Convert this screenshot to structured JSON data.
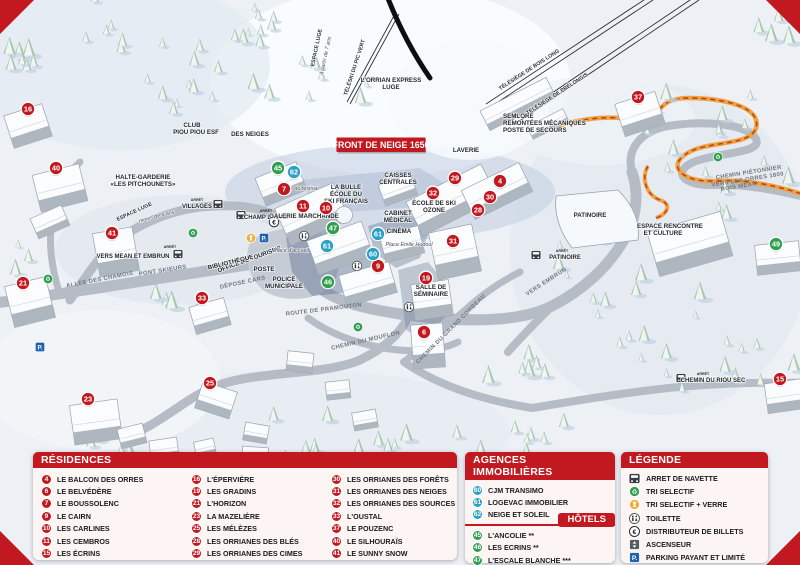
{
  "map": {
    "banner_label": "FRONT DE NEIGE 1650",
    "bus_caption": "ARRÊT",
    "markers": [
      {
        "n": "16",
        "t": "r",
        "x": 28,
        "y": 109
      },
      {
        "n": "40",
        "t": "r",
        "x": 56,
        "y": 168
      },
      {
        "n": "41",
        "t": "r",
        "x": 112,
        "y": 233
      },
      {
        "n": "21",
        "t": "r",
        "x": 23,
        "y": 283
      },
      {
        "n": "33",
        "t": "r",
        "x": 202,
        "y": 298
      },
      {
        "n": "23",
        "t": "r",
        "x": 88,
        "y": 399
      },
      {
        "n": "25",
        "t": "r",
        "x": 210,
        "y": 383
      },
      {
        "n": "7",
        "t": "r",
        "x": 284,
        "y": 189
      },
      {
        "n": "11",
        "t": "r",
        "x": 303,
        "y": 206
      },
      {
        "n": "10",
        "t": "r",
        "x": 326,
        "y": 208
      },
      {
        "n": "9",
        "t": "r",
        "x": 378,
        "y": 266
      },
      {
        "n": "19",
        "t": "r",
        "x": 426,
        "y": 278
      },
      {
        "n": "6",
        "t": "r",
        "x": 424,
        "y": 332
      },
      {
        "n": "29",
        "t": "r",
        "x": 455,
        "y": 178
      },
      {
        "n": "4",
        "t": "r",
        "x": 500,
        "y": 181
      },
      {
        "n": "32",
        "t": "r",
        "x": 433,
        "y": 193
      },
      {
        "n": "30",
        "t": "r",
        "x": 490,
        "y": 197
      },
      {
        "n": "28",
        "t": "r",
        "x": 478,
        "y": 210
      },
      {
        "n": "31",
        "t": "r",
        "x": 453,
        "y": 241
      },
      {
        "n": "37",
        "t": "r",
        "x": 638,
        "y": 97
      },
      {
        "n": "15",
        "t": "r",
        "x": 780,
        "y": 379
      },
      {
        "n": "62",
        "t": "a",
        "x": 294,
        "y": 172
      },
      {
        "n": "61",
        "t": "a",
        "x": 378,
        "y": 234
      },
      {
        "n": "61",
        "t": "a",
        "x": 327,
        "y": 246
      },
      {
        "n": "60",
        "t": "a",
        "x": 373,
        "y": 254
      },
      {
        "n": "45",
        "t": "h",
        "x": 278,
        "y": 168
      },
      {
        "n": "47",
        "t": "h",
        "x": 333,
        "y": 228
      },
      {
        "n": "46",
        "t": "h",
        "x": 328,
        "y": 282
      },
      {
        "n": "49",
        "t": "h",
        "x": 776,
        "y": 244
      }
    ],
    "labels": [
      {
        "t": "LAVERIE",
        "x": 466,
        "y": 152,
        "c": "poi"
      },
      {
        "t": "CAISSES",
        "x": 398,
        "y": 177,
        "c": "poi"
      },
      {
        "t": "CENTRALES",
        "x": 398,
        "y": 184,
        "c": "poi"
      },
      {
        "t": "ÉCOLE DE SKI",
        "x": 434,
        "y": 205,
        "c": "poi"
      },
      {
        "t": "OZONE",
        "x": 434,
        "y": 212,
        "c": "poi"
      },
      {
        "t": "CABINET",
        "x": 398,
        "y": 215,
        "c": "poi"
      },
      {
        "t": "MÉDICAL",
        "x": 398,
        "y": 222,
        "c": "poi"
      },
      {
        "t": "CINÉMA",
        "x": 399,
        "y": 233,
        "c": "poi"
      },
      {
        "t": "LA BULLE",
        "x": 346,
        "y": 189,
        "c": "poi"
      },
      {
        "t": "ÉCOLE DU",
        "x": 346,
        "y": 196,
        "c": "poi"
      },
      {
        "t": "SKI FRANÇAIS",
        "x": 346,
        "y": 203,
        "c": "poi"
      },
      {
        "t": "GALERIE MARCHANDE",
        "x": 304,
        "y": 218,
        "c": "poi"
      },
      {
        "t": "SALLE DE",
        "x": 431,
        "y": 289,
        "c": "poi"
      },
      {
        "t": "SÉMINAIRE",
        "x": 431,
        "y": 296,
        "c": "poi"
      },
      {
        "t": "PATINOIRE",
        "x": 590,
        "y": 217,
        "c": "poi"
      },
      {
        "t": "ESPACE RENCONTRE",
        "x": 670,
        "y": 228,
        "c": "poi"
      },
      {
        "t": "ET CULTURE",
        "x": 663,
        "y": 235,
        "c": "poi"
      },
      {
        "t": "POSTE",
        "x": 264,
        "y": 271,
        "c": "poi"
      },
      {
        "t": "POLICE",
        "x": 284,
        "y": 281,
        "c": "poi"
      },
      {
        "t": "MUNICIPALE",
        "x": 284,
        "y": 288,
        "c": "poi"
      },
      {
        "t": "OFFICE DE TOURISME",
        "x": 250,
        "y": 261,
        "r": -20,
        "c": "poi"
      },
      {
        "t": "BIBLIOTHÈQUE",
        "x": 231,
        "y": 264,
        "r": -14,
        "c": "poi"
      },
      {
        "t": "HALTE-GARDERIE",
        "x": 143,
        "y": 179,
        "c": "poi"
      },
      {
        "t": "«LES PITCHOUNETS»",
        "x": 143,
        "y": 186,
        "c": "poi"
      },
      {
        "t": "CLUB",
        "x": 192,
        "y": 127,
        "c": "poi"
      },
      {
        "t": "PIOU PIOU ESF",
        "x": 196,
        "y": 134,
        "c": "poi"
      },
      {
        "t": "DES NEIGES",
        "x": 250,
        "y": 136,
        "c": "poi"
      },
      {
        "t": "SEMLORE",
        "x": 503,
        "y": 118,
        "a": "start",
        "c": "poi"
      },
      {
        "t": "REMONTÉES MÉCANIQUES",
        "x": 503,
        "y": 125,
        "a": "start",
        "c": "poi"
      },
      {
        "t": "POSTE DE SECOURS",
        "x": 503,
        "y": 132,
        "a": "start",
        "c": "poi"
      },
      {
        "t": "L'ORRIAN EXPRESS",
        "x": 391,
        "y": 82,
        "c": "poi"
      },
      {
        "t": "LUGE",
        "x": 391,
        "y": 89,
        "c": "poi"
      },
      {
        "t": "PONT SKIEURS",
        "x": 163,
        "y": 272,
        "r": -9,
        "c": "road"
      },
      {
        "t": "ALLÉE DES CHAMOIS",
        "x": 100,
        "y": 281,
        "r": -11,
        "c": "road"
      },
      {
        "t": "DÉPOSE CARS",
        "x": 243,
        "y": 284,
        "r": -12,
        "c": "road"
      },
      {
        "t": "ROUTE DE PRAMOUTON",
        "x": 324,
        "y": 311,
        "r": -7,
        "c": "road"
      },
      {
        "t": "CHEMIN DU MOUFLON",
        "x": 366,
        "y": 342,
        "r": -13,
        "c": "road"
      },
      {
        "t": "CHEMIN DU GRAND CORBEAU",
        "x": 452,
        "y": 330,
        "r": -45,
        "c": "road"
      },
      {
        "t": "VERS EMBRUN",
        "x": 547,
        "y": 283,
        "r": -33,
        "c": "road"
      },
      {
        "t": "CHEMIN PIÉTONNIER",
        "x": 749,
        "y": 174,
        "r": -9,
        "c": "road"
      },
      {
        "t": "VERS LES ORRES 1800",
        "x": 748,
        "y": 181,
        "r": -9,
        "c": "road"
      },
      {
        "t": "BOIS MÉAN",
        "x": 739,
        "y": 188,
        "r": -9,
        "c": "road"
      },
      {
        "t": "TÉLÉSIÈGE DE BOIS LONG",
        "x": 530,
        "y": 71,
        "r": -33,
        "c": "lift"
      },
      {
        "t": "TÉLÉSIÈGE DE PRÉLONGIS",
        "x": 558,
        "y": 95,
        "r": -33,
        "c": "lift"
      },
      {
        "t": "TÉLÉSKI DU PIC VERT",
        "x": 356,
        "y": 68,
        "r": -72,
        "c": "lift"
      },
      {
        "t": "ESPACE LUGE",
        "x": 318,
        "y": 48,
        "r": -78,
        "c": "lift"
      },
      {
        "t": "à partir de 7 ans",
        "x": 327,
        "y": 56,
        "r": -78,
        "c": "place"
      },
      {
        "t": "ESPACE LUGE",
        "x": 135,
        "y": 213,
        "r": -25,
        "c": "lift"
      },
      {
        "t": "moins de 6 ans",
        "x": 157,
        "y": 218,
        "r": -15,
        "c": "place"
      },
      {
        "t": "Place du festival",
        "x": 299,
        "y": 190,
        "c": "place"
      },
      {
        "t": "Place d'accueil",
        "x": 291,
        "y": 252,
        "c": "place"
      },
      {
        "t": "Place Émile Hodoul",
        "x": 409,
        "y": 246,
        "c": "place"
      }
    ],
    "bus_stops": [
      {
        "label": "VILLAGES",
        "lx": 197,
        "ly": 208,
        "ix": 218,
        "iy": 204,
        "cx": 197,
        "cy": 201
      },
      {
        "label": "CHAMP LACAS",
        "lx": 266,
        "ly": 219,
        "ix": 241,
        "iy": 215,
        "cx": 266,
        "cy": 212
      },
      {
        "label": "VERS MEAN ET EMBRUN",
        "lx": 133,
        "ly": 258,
        "ix": 178,
        "iy": 254,
        "cx": 170,
        "cy": 248
      },
      {
        "label": "PATINOIRE",
        "lx": 565,
        "ly": 259,
        "ix": 536,
        "iy": 255,
        "cx": 562,
        "cy": 252
      },
      {
        "label": "CHEMIN DU RIOU SEC",
        "lx": 713,
        "ly": 382,
        "ix": 681,
        "iy": 378,
        "cx": 703,
        "cy": 375
      }
    ],
    "poi_icons": [
      {
        "type": "parking",
        "x": 264,
        "y": 238
      },
      {
        "type": "parking",
        "x": 40,
        "y": 347
      },
      {
        "type": "glass",
        "x": 251,
        "y": 238
      },
      {
        "type": "recycle",
        "x": 193,
        "y": 233
      },
      {
        "type": "recycle",
        "x": 48,
        "y": 279
      },
      {
        "type": "recycle",
        "x": 358,
        "y": 327
      },
      {
        "type": "recycle",
        "x": 718,
        "y": 157
      },
      {
        "type": "toilet",
        "x": 304,
        "y": 236
      },
      {
        "type": "toilet",
        "x": 357,
        "y": 266
      },
      {
        "type": "toilet",
        "x": 409,
        "y": 307
      },
      {
        "type": "atm",
        "x": 274,
        "y": 222
      }
    ]
  },
  "panels": {
    "residences": {
      "title": "RÉSIDENCES",
      "columns": [
        [
          {
            "n": "4",
            "label": "LE BALCON DES ORRES"
          },
          {
            "n": "6",
            "label": "LE BELVÉDÈRE"
          },
          {
            "n": "7",
            "label": "LE BOUSSOLENC"
          },
          {
            "n": "9",
            "label": "LE CAIRN"
          },
          {
            "n": "10",
            "label": "LES CARLINES"
          },
          {
            "n": "11",
            "label": "LES CEMBROS"
          },
          {
            "n": "15",
            "label": "LES ÉCRINS"
          }
        ],
        [
          {
            "n": "16",
            "label": "L'ÉPERVIÈRE"
          },
          {
            "n": "19",
            "label": "LES GRADINS"
          },
          {
            "n": "21",
            "label": "L'HORIZON"
          },
          {
            "n": "23",
            "label": "LA MAZELIÈRE"
          },
          {
            "n": "25",
            "label": "LES MÉLÈZES"
          },
          {
            "n": "28",
            "label": "LES ORRIANES DES BLÉS"
          },
          {
            "n": "29",
            "label": "LES ORRIANES DES CIMES"
          }
        ],
        [
          {
            "n": "30",
            "label": "LES ORRIANES DES FORÊTS"
          },
          {
            "n": "31",
            "label": "LES ORRIANES DES NEIGES"
          },
          {
            "n": "32",
            "label": "LES ORRIANES DES SOURCES"
          },
          {
            "n": "33",
            "label": "L'OUSTAL"
          },
          {
            "n": "37",
            "label": "LE POUZENC"
          },
          {
            "n": "40",
            "label": "LE SILHOURAÏS"
          },
          {
            "n": "41",
            "label": "LE SUNNY SNOW"
          }
        ]
      ]
    },
    "agences": {
      "title": "AGENCES IMMOBILIÈRES",
      "items": [
        {
          "n": "60",
          "label": "CJM TRANSIMO"
        },
        {
          "n": "61",
          "label": "LOGEVAC IMMOBILIER"
        },
        {
          "n": "62",
          "label": "NEIGE ET SOLEIL"
        }
      ]
    },
    "hotels": {
      "title": "HÔTELS",
      "items": [
        {
          "n": "45",
          "label": "L'ANCOLIE **"
        },
        {
          "n": "46",
          "label": "LES ECRINS **"
        },
        {
          "n": "47",
          "label": "L'ESCALE BLANCHE ***"
        },
        {
          "n": "49",
          "label": "LES TRAPPEURS **"
        }
      ]
    },
    "legende": {
      "title": "LÉGENDE",
      "items": [
        {
          "icon": "bus",
          "label": "ARRET DE NAVETTE"
        },
        {
          "icon": "recycle",
          "label": "TRI SELECTIF"
        },
        {
          "icon": "glass",
          "label": "TRI SELECTIF + VERRE"
        },
        {
          "icon": "toilet",
          "label": "TOILETTE"
        },
        {
          "icon": "atm",
          "label": "DISTRIBUTEUR DE BILLETS"
        },
        {
          "icon": "elevator",
          "label": "ASCENSEUR"
        },
        {
          "icon": "parking",
          "label": "PARKING PAYANT ET LIMITÉ"
        }
      ]
    }
  },
  "colors": {
    "residence": "#c2181f",
    "agence": "#2b9fc4",
    "hotel": "#2f9e4e",
    "bar": "#c2181f"
  }
}
